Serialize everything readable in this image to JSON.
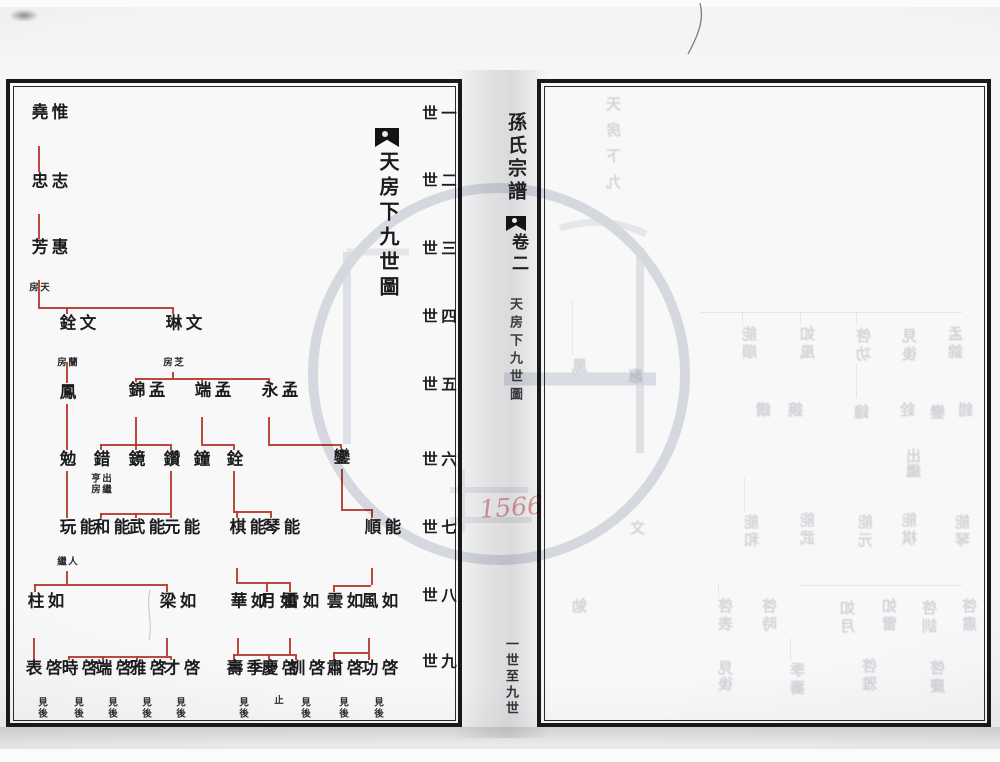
{
  "left_page": {
    "title": {
      "text": "天房下九世圖"
    },
    "generation_labels": [
      {
        "t": "一世",
        "y": 105
      },
      {
        "t": "二世",
        "y": 172
      },
      {
        "t": "三世",
        "y": 240
      },
      {
        "t": "四世",
        "y": 308
      },
      {
        "t": "五世",
        "y": 376
      },
      {
        "t": "六世",
        "y": 451
      },
      {
        "t": "七世",
        "y": 519
      },
      {
        "t": "八世",
        "y": 587
      },
      {
        "t": "九世",
        "y": 653
      }
    ],
    "line_color": "#b5392c",
    "nodes": [
      {
        "name": "惟堯",
        "gen": 1,
        "x": 38,
        "y": 103
      },
      {
        "name": "志忠",
        "gen": 2,
        "x": 38,
        "y": 172
      },
      {
        "name": "惠芳",
        "gen": 3,
        "x": 38,
        "y": 238,
        "note": {
          "t": "天房",
          "l": 27,
          "y": 282,
          "h": 14
        }
      },
      {
        "name": "文銓",
        "gen": 4,
        "x": 66,
        "y": 314,
        "note": {
          "t": "蘭房",
          "l": 55,
          "y": 357,
          "h": 14
        }
      },
      {
        "name": "文琳",
        "gen": 4,
        "x": 172,
        "y": 314,
        "note": {
          "t": "芝房",
          "l": 161,
          "y": 357,
          "h": 14
        }
      },
      {
        "name": "鳳",
        "gen": 5,
        "x": 66,
        "y": 383
      },
      {
        "name": "孟錦",
        "gen": 5,
        "x": 135,
        "y": 381
      },
      {
        "name": "孟端",
        "gen": 5,
        "x": 201,
        "y": 381
      },
      {
        "name": "孟永",
        "gen": 5,
        "x": 268,
        "y": 381
      },
      {
        "name": "勉",
        "gen": 6,
        "x": 66,
        "y": 450
      },
      {
        "name": "錯",
        "gen": 6,
        "x": 100,
        "y": 450,
        "note": {
          "t": "出繼亨房",
          "l": 89,
          "y": 473,
          "h": 27
        }
      },
      {
        "name": "鏡",
        "gen": 6,
        "x": 135,
        "y": 450
      },
      {
        "name": "鑽",
        "gen": 6,
        "x": 170,
        "y": 450
      },
      {
        "name": "鐘",
        "gen": 6,
        "x": 200,
        "y": 450
      },
      {
        "name": "銓",
        "gen": 6,
        "x": 233,
        "y": 450
      },
      {
        "name": "鑾",
        "gen": 6,
        "x": 340,
        "y": 448
      },
      {
        "name": "能玩",
        "gen": 7,
        "x": 66,
        "y": 518,
        "note": {
          "t": "人繼",
          "l": 55,
          "y": 556,
          "h": 14
        }
      },
      {
        "name": "能和",
        "gen": 7,
        "x": 100,
        "y": 518
      },
      {
        "name": "能武",
        "gen": 7,
        "x": 135,
        "y": 518
      },
      {
        "name": "能元",
        "gen": 7,
        "x": 170,
        "y": 518
      },
      {
        "name": "能棋",
        "gen": 7,
        "x": 236,
        "y": 518
      },
      {
        "name": "能琴",
        "gen": 7,
        "x": 270,
        "y": 518
      },
      {
        "name": "能順",
        "gen": 7,
        "x": 371,
        "y": 518
      },
      {
        "name": "如柱",
        "gen": 8,
        "x": 34,
        "y": 592
      },
      {
        "name": "如梁",
        "gen": 8,
        "x": 166,
        "y": 592
      },
      {
        "name": "如華",
        "gen": 8,
        "x": 237,
        "y": 592
      },
      {
        "name": "如月",
        "gen": 8,
        "x": 266,
        "y": 592
      },
      {
        "name": "如雷",
        "gen": 8,
        "x": 289,
        "y": 592
      },
      {
        "name": "如雲",
        "gen": 8,
        "x": 333,
        "y": 592
      },
      {
        "name": "如風",
        "gen": 8,
        "x": 368,
        "y": 592
      },
      {
        "name": "啓表",
        "gen": 9,
        "x": 32,
        "y": 659,
        "note": {
          "t": "見後",
          "l": 36,
          "y": 697,
          "h": 30
        }
      },
      {
        "name": "啓時",
        "gen": 9,
        "x": 68,
        "y": 659,
        "note": {
          "t": "見後",
          "l": 72,
          "y": 697,
          "h": 30
        }
      },
      {
        "name": "啓端",
        "gen": 9,
        "x": 102,
        "y": 659,
        "note": {
          "t": "見後",
          "l": 106,
          "y": 697,
          "h": 30
        }
      },
      {
        "name": "啓雅",
        "gen": 9,
        "x": 136,
        "y": 659,
        "note": {
          "t": "見後",
          "l": 140,
          "y": 697,
          "h": 30
        }
      },
      {
        "name": "啓才",
        "gen": 9,
        "x": 170,
        "y": 659,
        "note": {
          "t": "見後",
          "l": 174,
          "y": 697,
          "h": 30
        }
      },
      {
        "name": "季壽",
        "gen": 9,
        "x": 233,
        "y": 659,
        "note": {
          "t": "見後",
          "l": 237,
          "y": 697,
          "h": 30
        }
      },
      {
        "name": "啓慶",
        "gen": 9,
        "x": 268,
        "y": 659,
        "note": {
          "t": "止",
          "l": 272,
          "y": 695,
          "h": 16
        }
      },
      {
        "name": "啓訓",
        "gen": 9,
        "x": 295,
        "y": 659,
        "note": {
          "t": "見後",
          "l": 299,
          "y": 697,
          "h": 30
        }
      },
      {
        "name": "啓肅",
        "gen": 9,
        "x": 333,
        "y": 659,
        "note": {
          "t": "見後",
          "l": 337,
          "y": 697,
          "h": 30
        }
      },
      {
        "name": "啓功",
        "gen": 9,
        "x": 368,
        "y": 659,
        "note": {
          "t": "見後",
          "l": 372,
          "y": 697,
          "h": 30
        }
      }
    ],
    "lines": [
      [
        38,
        146,
        38,
        172
      ],
      [
        38,
        214,
        38,
        239
      ],
      [
        38,
        280,
        38,
        307
      ],
      [
        38,
        307,
        172,
        307
      ],
      [
        66,
        307,
        66,
        314
      ],
      [
        172,
        307,
        172,
        314
      ],
      [
        66,
        362,
        66,
        383
      ],
      [
        172,
        372,
        172,
        378
      ],
      [
        135,
        378,
        268,
        378
      ],
      [
        135,
        378,
        135,
        382
      ],
      [
        201,
        378,
        201,
        382
      ],
      [
        268,
        378,
        268,
        382
      ],
      [
        66,
        404,
        66,
        450
      ],
      [
        135,
        417,
        135,
        444
      ],
      [
        100,
        444,
        170,
        444
      ],
      [
        100,
        444,
        100,
        450
      ],
      [
        135,
        444,
        135,
        450
      ],
      [
        170,
        444,
        170,
        450
      ],
      [
        201,
        417,
        201,
        444
      ],
      [
        201,
        444,
        233,
        444
      ],
      [
        233,
        444,
        233,
        450
      ],
      [
        268,
        417,
        268,
        444
      ],
      [
        268,
        444,
        340,
        444
      ],
      [
        340,
        444,
        340,
        448
      ],
      [
        66,
        471,
        66,
        518
      ],
      [
        170,
        471,
        170,
        513
      ],
      [
        100,
        513,
        170,
        513
      ],
      [
        100,
        513,
        100,
        518
      ],
      [
        135,
        513,
        135,
        518
      ],
      [
        170,
        513,
        170,
        518
      ],
      [
        233,
        471,
        233,
        511
      ],
      [
        233,
        511,
        270,
        511
      ],
      [
        236,
        511,
        236,
        518
      ],
      [
        270,
        511,
        270,
        518
      ],
      [
        341,
        469,
        341,
        509
      ],
      [
        341,
        509,
        371,
        509
      ],
      [
        371,
        509,
        371,
        518
      ],
      [
        66,
        571,
        66,
        584
      ],
      [
        34,
        584,
        166,
        584
      ],
      [
        34,
        584,
        34,
        592
      ],
      [
        166,
        584,
        166,
        592
      ],
      [
        236,
        568,
        236,
        582
      ],
      [
        236,
        582,
        289,
        582
      ],
      [
        266,
        582,
        266,
        592
      ],
      [
        289,
        582,
        289,
        592
      ],
      [
        371,
        568,
        371,
        585
      ],
      [
        333,
        585,
        371,
        585
      ],
      [
        333,
        585,
        333,
        592
      ],
      [
        33,
        638,
        33,
        659
      ],
      [
        166,
        638,
        166,
        656
      ],
      [
        68,
        656,
        170,
        656
      ],
      [
        68,
        656,
        68,
        660
      ],
      [
        102,
        656,
        102,
        660
      ],
      [
        136,
        656,
        136,
        660
      ],
      [
        170,
        656,
        170,
        660
      ],
      [
        237,
        638,
        237,
        654
      ],
      [
        289,
        638,
        289,
        654
      ],
      [
        233,
        654,
        295,
        654
      ],
      [
        233,
        654,
        233,
        660
      ],
      [
        268,
        654,
        268,
        660
      ],
      [
        295,
        654,
        295,
        660
      ],
      [
        368,
        638,
        368,
        652
      ],
      [
        333,
        652,
        368,
        652
      ],
      [
        333,
        652,
        333,
        660
      ],
      [
        368,
        652,
        368,
        660
      ]
    ]
  },
  "spine": {
    "book_title": "孫氏宗譜",
    "volume_label": "卷二",
    "chapter_label": "天房下九世圖",
    "range_label": "一世至九世"
  },
  "right_page": {
    "stamp_number": "1566",
    "ghost_chars": [
      {
        "t": "天",
        "x": 606,
        "y": 96
      },
      {
        "t": "房",
        "x": 606,
        "y": 122
      },
      {
        "t": "下",
        "x": 606,
        "y": 148
      },
      {
        "t": "九",
        "x": 606,
        "y": 174
      },
      {
        "t": "鳳",
        "x": 572,
        "y": 358
      },
      {
        "t": "惠",
        "x": 628,
        "y": 368
      },
      {
        "t": "文",
        "x": 630,
        "y": 520
      },
      {
        "t": "勉",
        "x": 572,
        "y": 598
      },
      {
        "t": "能",
        "x": 742,
        "y": 326
      },
      {
        "t": "順",
        "x": 742,
        "y": 344
      },
      {
        "t": "如",
        "x": 800,
        "y": 326
      },
      {
        "t": "風",
        "x": 800,
        "y": 344
      },
      {
        "t": "啓",
        "x": 856,
        "y": 328
      },
      {
        "t": "功",
        "x": 856,
        "y": 346
      },
      {
        "t": "見",
        "x": 902,
        "y": 328
      },
      {
        "t": "後",
        "x": 902,
        "y": 346
      },
      {
        "t": "孟",
        "x": 948,
        "y": 326
      },
      {
        "t": "錦",
        "x": 948,
        "y": 344
      },
      {
        "t": "鑽",
        "x": 756,
        "y": 402
      },
      {
        "t": "鏡",
        "x": 788,
        "y": 402
      },
      {
        "t": "鐘",
        "x": 854,
        "y": 404
      },
      {
        "t": "銓",
        "x": 900,
        "y": 402
      },
      {
        "t": "鑾",
        "x": 930,
        "y": 404
      },
      {
        "t": "錯",
        "x": 958,
        "y": 402
      },
      {
        "t": "出",
        "x": 906,
        "y": 448
      },
      {
        "t": "繼",
        "x": 906,
        "y": 463
      },
      {
        "t": "能",
        "x": 744,
        "y": 514
      },
      {
        "t": "和",
        "x": 744,
        "y": 532
      },
      {
        "t": "能",
        "x": 800,
        "y": 512
      },
      {
        "t": "武",
        "x": 800,
        "y": 530
      },
      {
        "t": "能",
        "x": 858,
        "y": 514
      },
      {
        "t": "元",
        "x": 858,
        "y": 532
      },
      {
        "t": "能",
        "x": 902,
        "y": 512
      },
      {
        "t": "棋",
        "x": 902,
        "y": 530
      },
      {
        "t": "能",
        "x": 955,
        "y": 514
      },
      {
        "t": "琴",
        "x": 955,
        "y": 532
      },
      {
        "t": "啓",
        "x": 718,
        "y": 598
      },
      {
        "t": "表",
        "x": 718,
        "y": 616
      },
      {
        "t": "啓",
        "x": 762,
        "y": 598
      },
      {
        "t": "時",
        "x": 762,
        "y": 616
      },
      {
        "t": "如",
        "x": 840,
        "y": 600
      },
      {
        "t": "月",
        "x": 840,
        "y": 618
      },
      {
        "t": "如",
        "x": 882,
        "y": 598
      },
      {
        "t": "雷",
        "x": 882,
        "y": 616
      },
      {
        "t": "啓",
        "x": 922,
        "y": 600
      },
      {
        "t": "訓",
        "x": 922,
        "y": 618
      },
      {
        "t": "啓",
        "x": 962,
        "y": 598
      },
      {
        "t": "肅",
        "x": 962,
        "y": 616
      },
      {
        "t": "見",
        "x": 718,
        "y": 660
      },
      {
        "t": "後",
        "x": 718,
        "y": 676
      },
      {
        "t": "季",
        "x": 790,
        "y": 662
      },
      {
        "t": "壽",
        "x": 790,
        "y": 680
      },
      {
        "t": "啓",
        "x": 862,
        "y": 658
      },
      {
        "t": "雅",
        "x": 862,
        "y": 676
      },
      {
        "t": "啓",
        "x": 930,
        "y": 660
      },
      {
        "t": "慶",
        "x": 930,
        "y": 678
      }
    ],
    "ghost_lines": [
      [
        700,
        312,
        962,
        312
      ],
      [
        742,
        312,
        742,
        325
      ],
      [
        800,
        312,
        800,
        325
      ],
      [
        856,
        312,
        856,
        325
      ],
      [
        572,
        300,
        572,
        355
      ],
      [
        744,
        478,
        744,
        512
      ],
      [
        800,
        585,
        962,
        585
      ],
      [
        790,
        638,
        790,
        660
      ],
      [
        856,
        364,
        856,
        398
      ],
      [
        718,
        585,
        718,
        596
      ]
    ]
  }
}
